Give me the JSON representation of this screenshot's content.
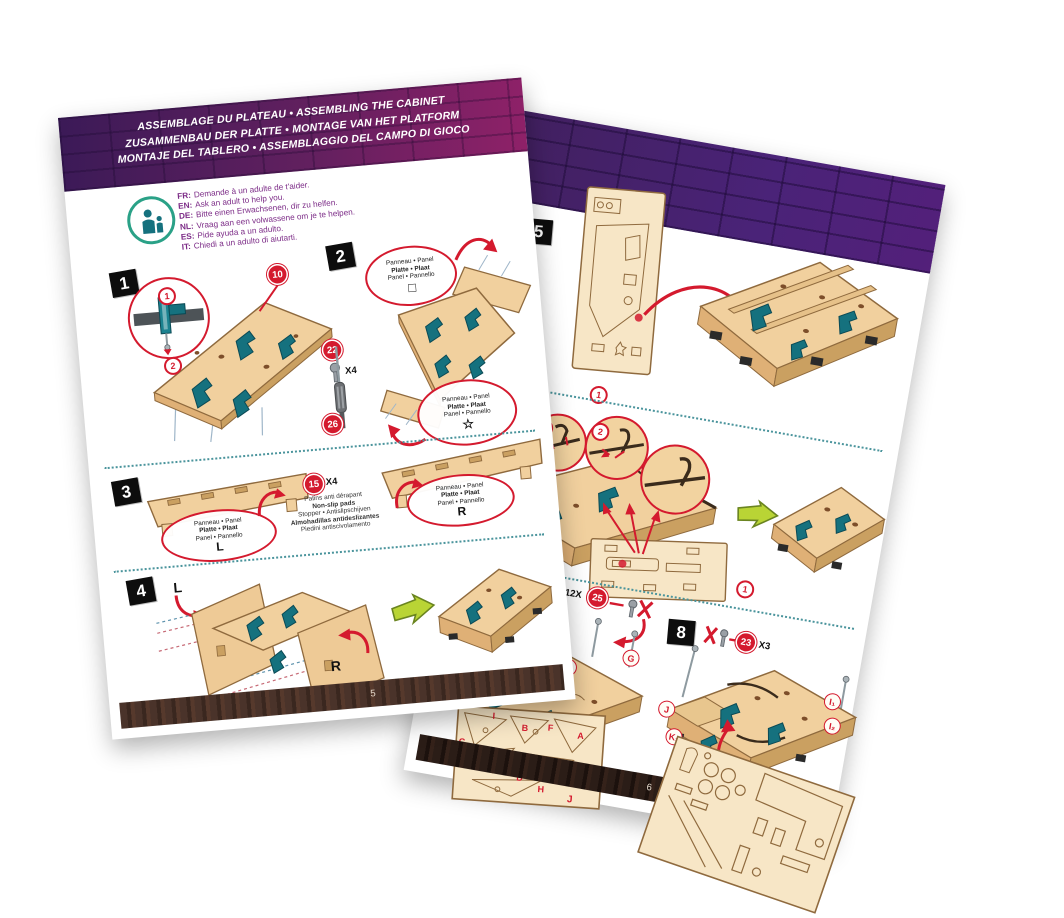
{
  "colors": {
    "accent_red": "#d41a2e",
    "part_teal": "#15717e",
    "wood_tan": "#f1d09e",
    "brick_purple": "#4a2378",
    "header_gradient": [
      "#3b1a57",
      "#8f2168"
    ],
    "arrow_green": "#b9d435",
    "footer_brown": "#4a332a",
    "footer_dark": "#2b1d17"
  },
  "shared": {
    "panel_label": {
      "l1": "Panneau • Panel",
      "l2": "Platte • Plaat",
      "l3": "Panel • Pannello"
    }
  },
  "left_page": {
    "page_number": "5",
    "header": {
      "line1": "ASSEMBLAGE DU PLATEAU • ASSEMBLING THE CABINET",
      "line2": "ZUSAMMENBAU DER PLATTE • MONTAGE VAN HET PLATFORM",
      "line3": "MONTAJE DEL TABLERO • ASSEMBLAGGIO DEL CAMPO DI GIOCO"
    },
    "adult_help": {
      "lines": [
        {
          "lang": "FR:",
          "text": "Demande à un adulte de t'aider."
        },
        {
          "lang": "EN:",
          "text": "Ask an adult to help you."
        },
        {
          "lang": "DE:",
          "text": "Bitte einen Erwachsenen, dir zu helfen."
        },
        {
          "lang": "NL:",
          "text": "Vraag aan een volwassene om je te helpen."
        },
        {
          "lang": "ES:",
          "text": "Pide ayuda a un adulto."
        },
        {
          "lang": "IT:",
          "text": "Chiedi a un adulto di aiutarti."
        }
      ]
    },
    "step1": {
      "number": "1",
      "marker1": "1",
      "marker2": "2",
      "part10": "10",
      "part22": "22",
      "part22_qty": "X4",
      "part26": "26"
    },
    "step2": {
      "number": "2",
      "symbol_square": "□",
      "symbol_star": "☆"
    },
    "step3": {
      "number": "3",
      "left_letter": "L",
      "right_letter": "R",
      "part15": "15",
      "part15_qty": "X4",
      "pads": {
        "fr": "Patins anti dérapant",
        "en": "Non-slip pads",
        "de_nl": "Stopper • Antislipschijven",
        "es": "Almohadillas antideslizantes",
        "it": "Piedini antiscivolamento"
      }
    },
    "step4": {
      "number": "4",
      "left_letter": "L",
      "right_letter": "R"
    }
  },
  "right_page": {
    "page_number": "6",
    "step5": {
      "number": "5",
      "marker1": "1"
    },
    "step6": {
      "number": "6",
      "marker1": "1",
      "marker2": "2",
      "panel_marker": "1"
    },
    "step7": {
      "qty": "12X",
      "part": "25",
      "letters": [
        "C",
        "E",
        "H",
        "B",
        "D",
        "F",
        "G"
      ],
      "sheet_letters": [
        "C",
        "I",
        "B",
        "F",
        "A",
        "E",
        "D",
        "G",
        "H",
        "J"
      ]
    },
    "step8": {
      "number": "8",
      "part": "23",
      "qty": "X3",
      "letters": [
        "J",
        "K₁",
        "K₂",
        "I₁",
        "I₂"
      ]
    }
  }
}
